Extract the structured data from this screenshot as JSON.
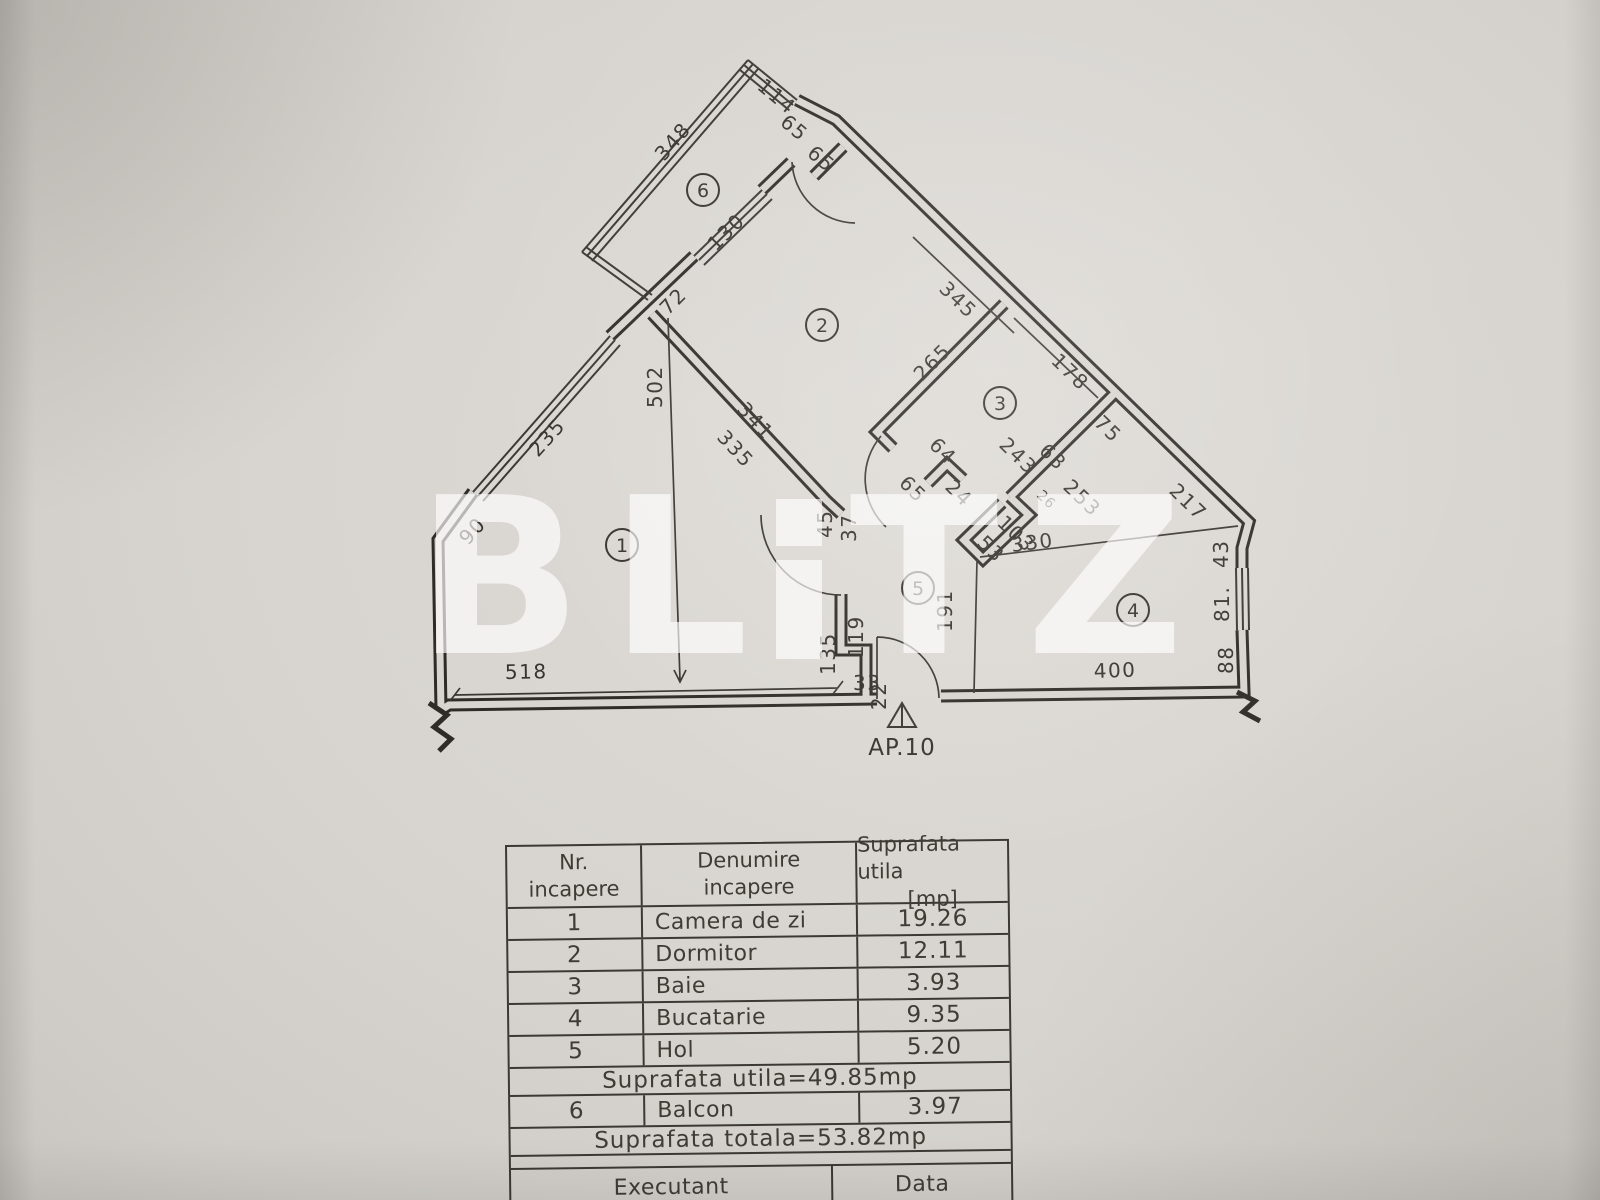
{
  "watermark": {
    "text": "BLITZ",
    "color": "#ffffff",
    "letters": {
      "b": "B",
      "l": "L",
      "t": "T",
      "z": "Z"
    }
  },
  "floor_plan": {
    "apartment_label": "AP.10",
    "room_numbers": [
      "1",
      "2",
      "3",
      "4",
      "5",
      "6"
    ],
    "dims": {
      "d348": "348",
      "d114": "114",
      "d65a": "65",
      "d65b": "65",
      "d130": "130",
      "d72": "72",
      "d502": "502",
      "d341": "341",
      "d335": "335",
      "d235": "235",
      "d90": "90",
      "d518": "518",
      "d135": "135",
      "d119": "119",
      "d33": "33",
      "d22": "22",
      "d45": "45",
      "d37": "37",
      "d345": "345",
      "d265": "265",
      "d64": "64",
      "d65c": "65",
      "d24": "24",
      "d178": "178",
      "d243": "243",
      "d63": "63",
      "d75": "75",
      "d253": "253",
      "d103": "103",
      "d26": "26",
      "d53": "53",
      "d330": "330",
      "d191": "191",
      "d400": "400",
      "d217": "217",
      "d43": "43",
      "d81": "81.",
      "d88": "88"
    },
    "line_color": "#2f2c28",
    "paper_color": "#d8d5d0"
  },
  "table": {
    "head": {
      "nr_l1": "Nr.",
      "nr_l2": "incapere",
      "den_l1": "Denumire",
      "den_l2": "incapere",
      "sup_l1": "Suprafata utila",
      "sup_l2": "[mp]"
    },
    "rows": [
      {
        "nr": "1",
        "name": "Camera de zi",
        "area": "19.26"
      },
      {
        "nr": "2",
        "name": "Dormitor",
        "area": "12.11"
      },
      {
        "nr": "3",
        "name": "Baie",
        "area": "3.93"
      },
      {
        "nr": "4",
        "name": "Bucatarie",
        "area": "9.35"
      },
      {
        "nr": "5",
        "name": "Hol",
        "area": "5.20"
      }
    ],
    "subtotal": "Suprafata  utila=49.85mp",
    "balcony_row": {
      "nr": "6",
      "name": "Balcon",
      "area": "3.97"
    },
    "total": "Suprafata  totala=53.82mp",
    "executant_label": "Executant",
    "data_label": "Data",
    "company": "SC CETOBOS SRL"
  }
}
